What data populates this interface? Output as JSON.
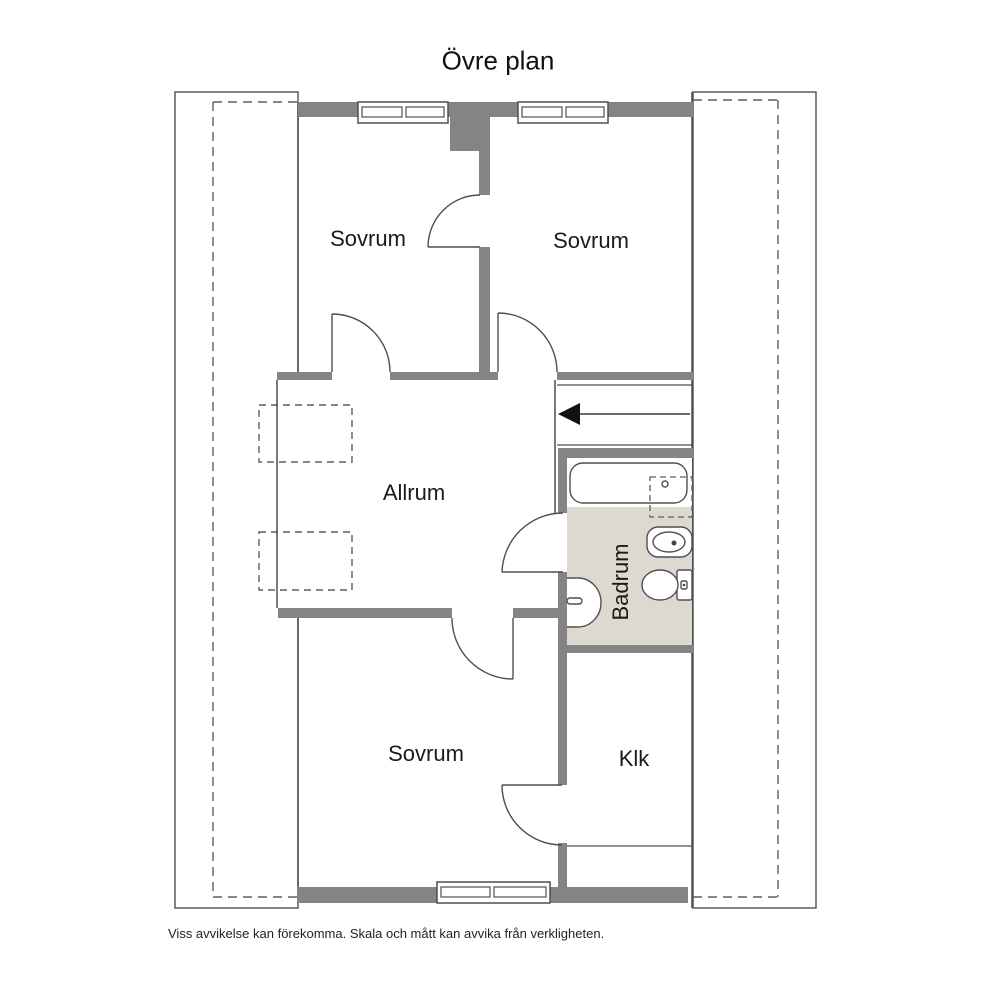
{
  "title": "Övre plan",
  "floor_plan": {
    "rooms": [
      {
        "id": "sovrum-top-left",
        "label": "Sovrum"
      },
      {
        "id": "sovrum-top-right",
        "label": "Sovrum"
      },
      {
        "id": "allrum",
        "label": "Allrum"
      },
      {
        "id": "badrum",
        "label": "Badrum"
      },
      {
        "id": "sovrum-bottom",
        "label": "Sovrum"
      },
      {
        "id": "klk",
        "label": "Klk"
      }
    ],
    "fixtures": [
      "bathtub",
      "sink",
      "toilet",
      "bidet",
      "stairs-down-arrow"
    ],
    "window_count": 3,
    "door_count": 6
  },
  "footer": "Viss avvikelse kan förekomma. Skala och mått kan avvika från verkligheten.",
  "colors": {
    "wall": "#848484",
    "line": "#4f4f4f",
    "bathroom_floor": "#ddd8d0",
    "text": "#1a1a1a"
  }
}
